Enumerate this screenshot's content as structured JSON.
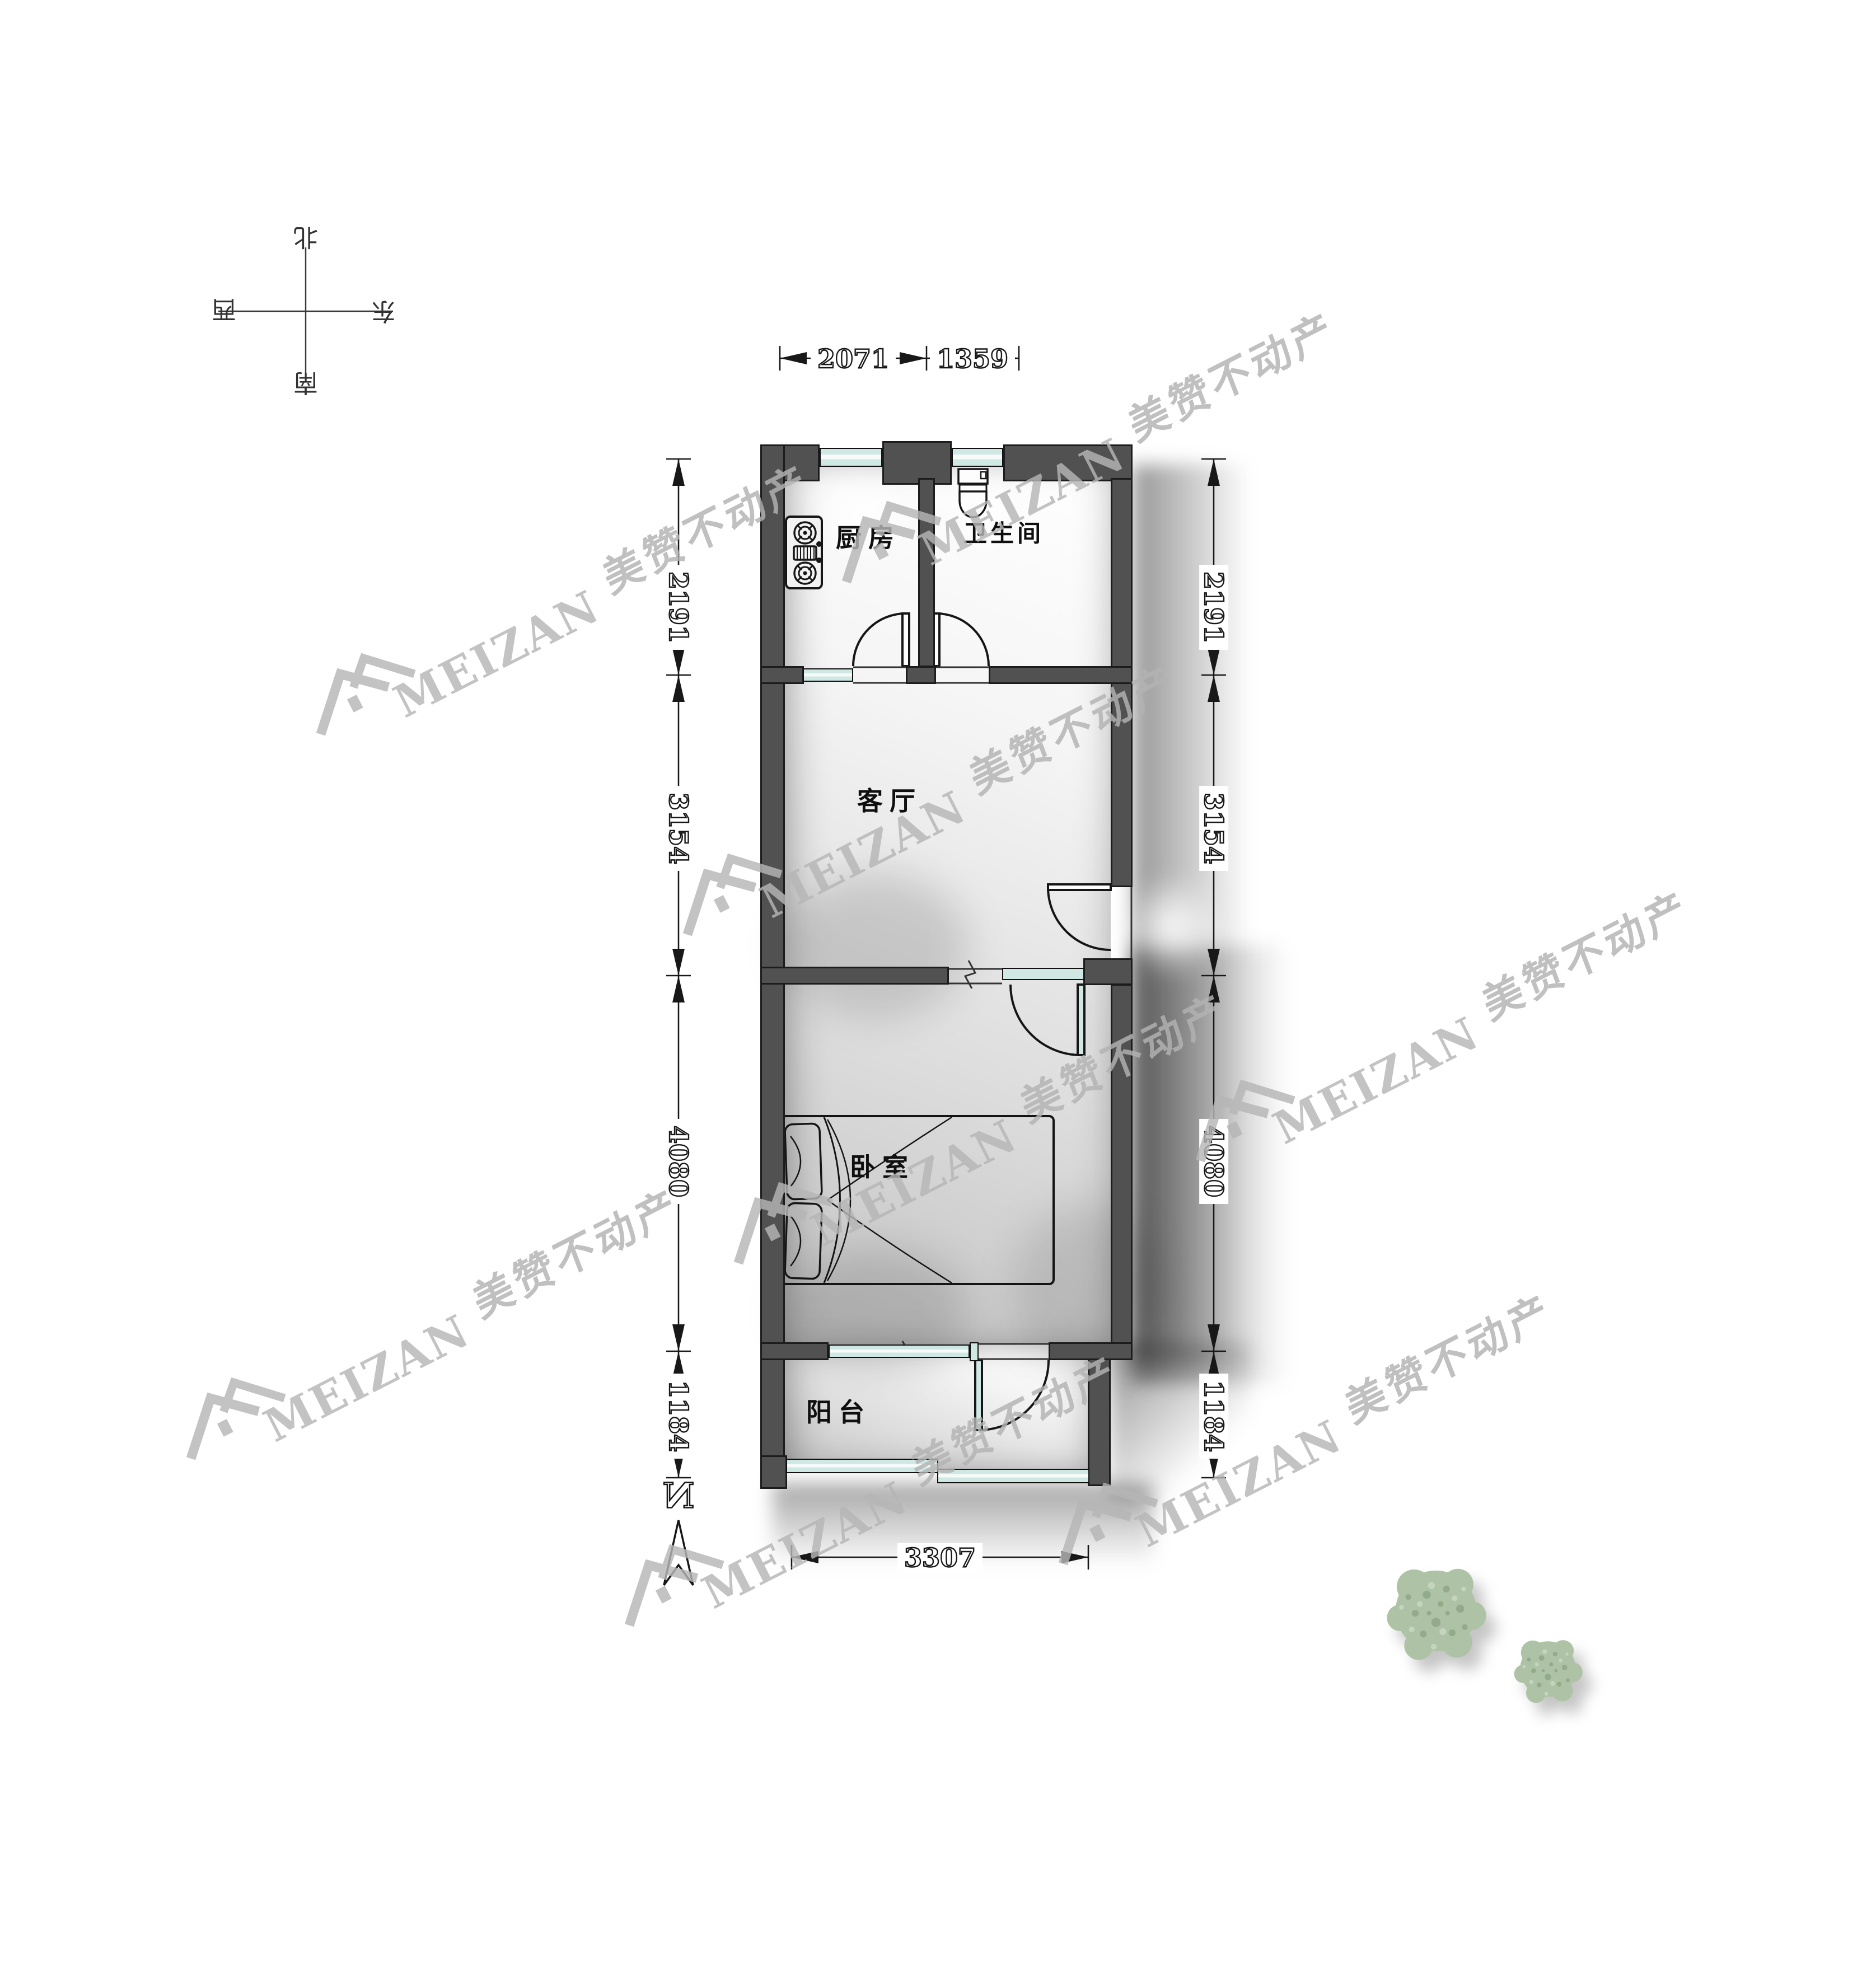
{
  "compass": {
    "north": "北",
    "east": "东",
    "south": "南",
    "west": "西"
  },
  "north_indicator": {
    "label": "N"
  },
  "rooms": [
    {
      "id": "kitchen",
      "label": "厨房"
    },
    {
      "id": "bathroom",
      "label": "卫生间"
    },
    {
      "id": "living_room",
      "label": "客厅"
    },
    {
      "id": "bedroom",
      "label": "卧室"
    },
    {
      "id": "balcony",
      "label": "阳台"
    }
  ],
  "dimensions": {
    "top": [
      {
        "value": "2071"
      },
      {
        "value": "1359"
      }
    ],
    "left": [
      {
        "value": "2191"
      },
      {
        "value": "3154"
      },
      {
        "value": "4080"
      },
      {
        "value": "1184"
      }
    ],
    "right": [
      {
        "value": "2191"
      },
      {
        "value": "3154"
      },
      {
        "value": "4080"
      },
      {
        "value": "1184"
      }
    ],
    "bottom": [
      {
        "value": "3307"
      }
    ]
  },
  "watermark": {
    "brand": "MEIZAN",
    "company": "美赞不动产"
  },
  "colors": {
    "wall": "#515151",
    "window_glass": "#cfe8e4",
    "foliage": "#aec3a6",
    "dimension_ink": "#181818",
    "watermark_gray": "#b5b5b5"
  }
}
